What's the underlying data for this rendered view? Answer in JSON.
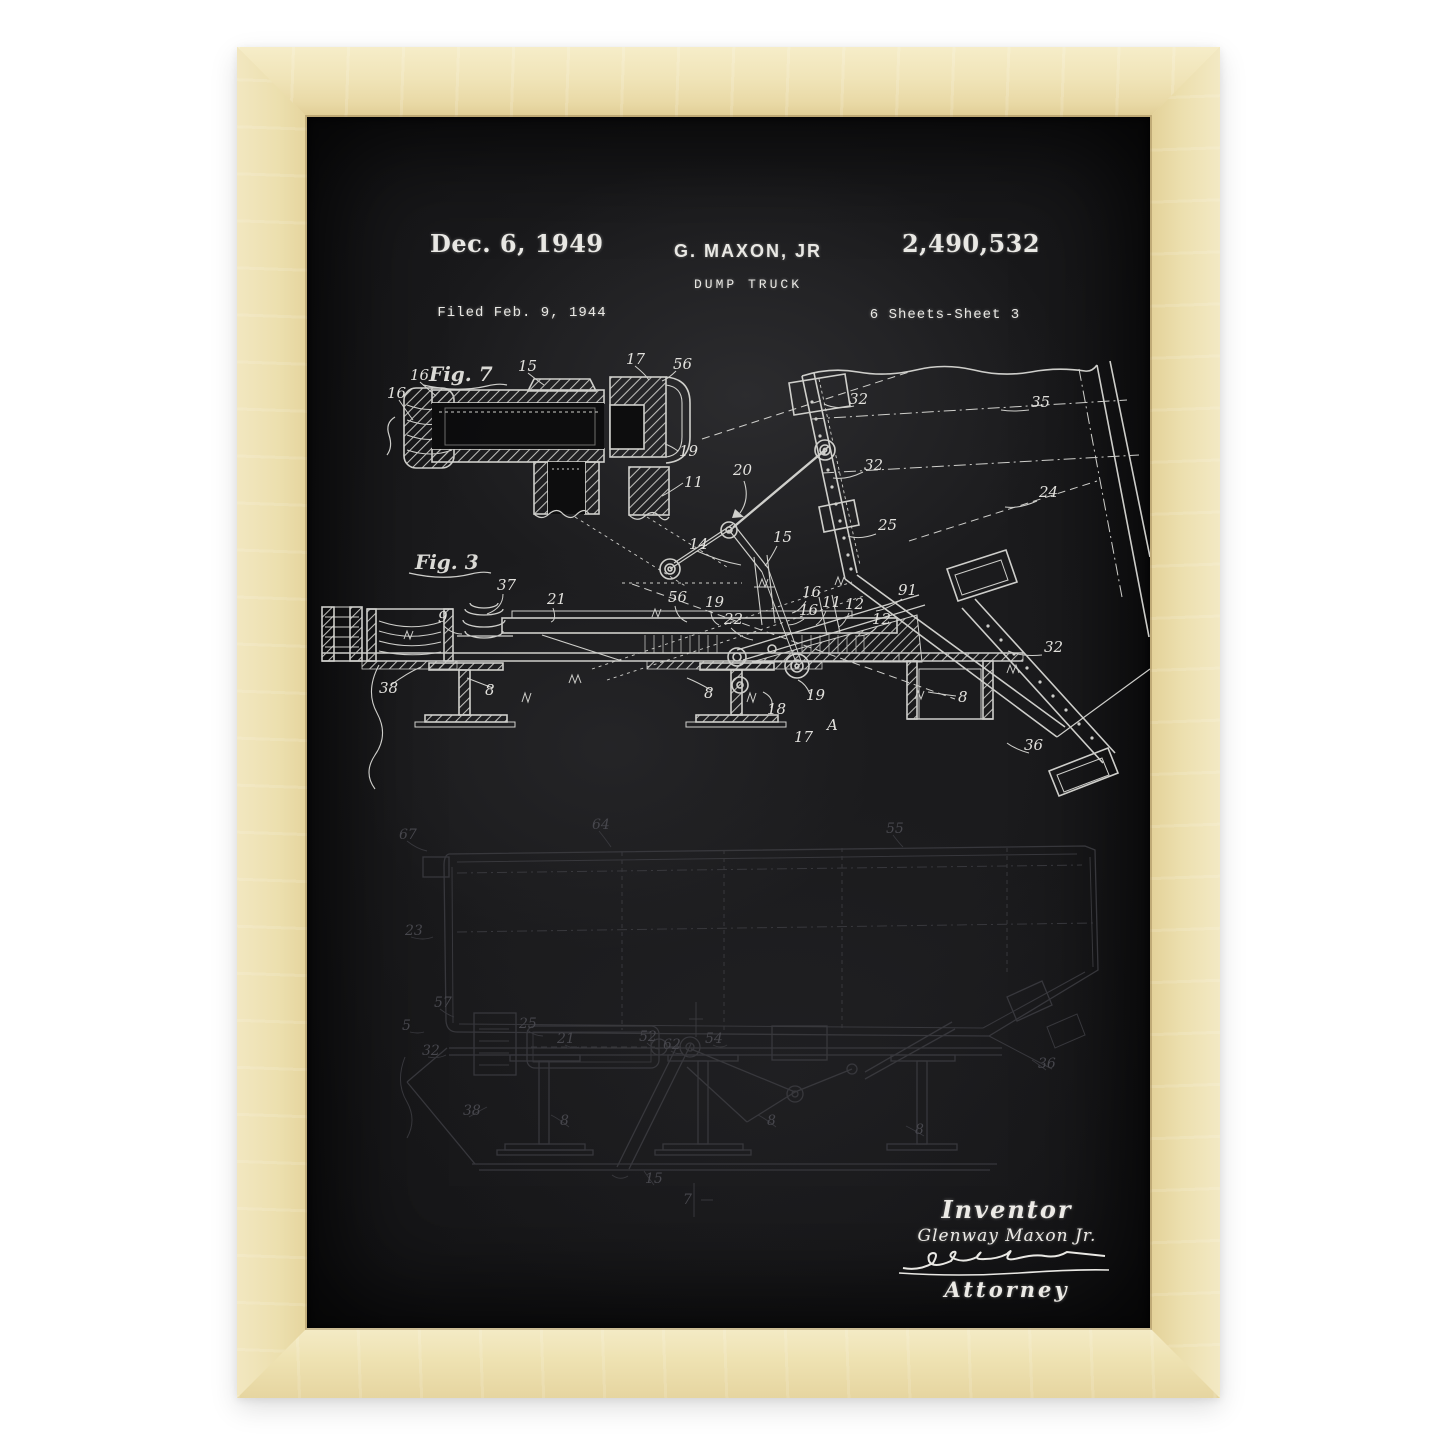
{
  "artwork": {
    "kind": "framed patent print photo",
    "colors": {
      "page_bg": "#ffffff",
      "frame_wood": "#eee2b2",
      "poster_bg": "#141415",
      "chalk": "#e6e5e1",
      "faint_chalk": "#3f3f45"
    }
  },
  "header": {
    "date": "Dec. 6, 1949",
    "filed": "Filed Feb. 9, 1944",
    "inventor": "G. MAXON, JR",
    "title": "DUMP TRUCK",
    "patent_number": "2,490,532",
    "sheet_info": "6 Sheets-Sheet 3"
  },
  "figures": {
    "fig7": {
      "caption": "Fig. 7",
      "labels": [
        "16",
        "16",
        "15",
        "17",
        "56",
        "19",
        "11"
      ]
    },
    "fig3": {
      "caption": "Fig. 3",
      "labels": [
        "37",
        "21",
        "9",
        "38",
        "8",
        "8",
        "8",
        "14",
        "56",
        "19",
        "22",
        "16",
        "16",
        "11",
        "12",
        "12",
        "91",
        "18",
        "19",
        "17",
        "A",
        "32",
        "35",
        "32",
        "24",
        "25",
        "20",
        "15",
        "32",
        "36"
      ]
    },
    "fig_bottom": {
      "labels": [
        "67",
        "64",
        "55",
        "23",
        "32",
        "25",
        "21",
        "52",
        "62",
        "54",
        "57",
        "5",
        "38",
        "8",
        "8",
        "8",
        "15",
        "7",
        "36"
      ]
    }
  },
  "signature": {
    "inventor_script": "Inventor",
    "inventor_name": "Glenway Maxon Jr.",
    "attorney_script": "Attorney"
  }
}
